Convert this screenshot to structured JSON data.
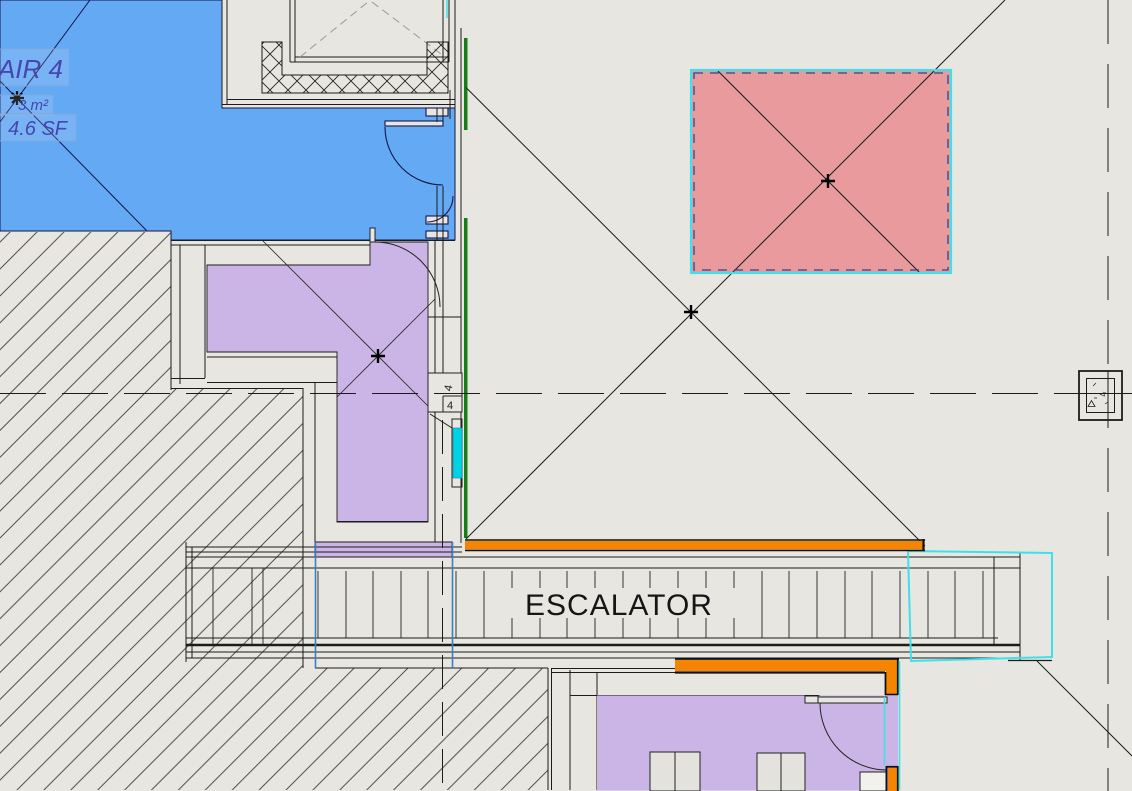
{
  "app": {
    "type": "cad-floor-plan-view"
  },
  "labels": {
    "escalator": "ESCALATOR",
    "room_tag": {
      "name": "AIR 4",
      "area_metric": "3 m²",
      "area_imperial": "4.6 SF"
    },
    "door_tag": {
      "upper": "4",
      "lower": "4"
    },
    "column_tag": "4"
  },
  "colors": {
    "bg": "#e7e6e1",
    "blue_room": "#63a9f4",
    "purple_room": "#cbb5e6",
    "pink_region": "#e89a9c",
    "orange": "#f58501",
    "cyan_highlight": "#3fe0ea",
    "cyan_fill": "#00d2e6",
    "green_line": "#177d17",
    "blue_guide": "#3c7ec1",
    "navy_dash": "#27489b",
    "tag_text": "#4646ad",
    "line": "#1c1c1c"
  }
}
